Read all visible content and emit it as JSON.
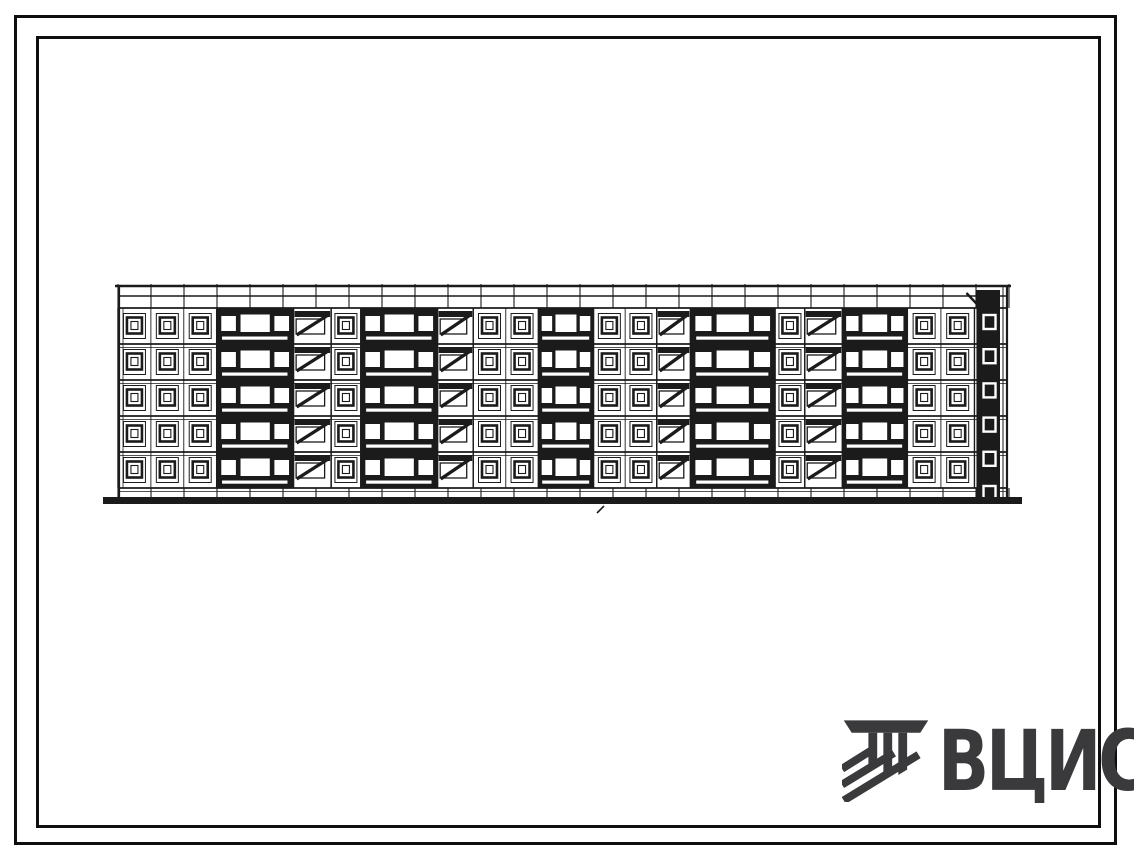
{
  "page": {
    "background": "#ffffff",
    "ink": "#1b1b1b",
    "paper": "#ffffff"
  },
  "frame": {
    "outer": "double rectangular border",
    "inner": "inner rectangular border"
  },
  "logo": {
    "text": "ВЦИС",
    "color": "#3a3a3c",
    "icon": "vcis-hatched-emblem-icon"
  },
  "drawing": {
    "type": "building-elevation",
    "subject": "5-storey large-panel apartment building, main facade elevation (scanned line drawing)",
    "floors": 5,
    "geometry": {
      "x": 118,
      "top": 286,
      "width": 890,
      "ground": 497,
      "parapet_h": 10,
      "band_h": 12,
      "plinth_h": 9,
      "ground_left_ext": 15,
      "ground_right_ext": 14,
      "ground_thickness": 7,
      "panel_step": 33
    },
    "artifact_mark": {
      "x": 597,
      "y": 510
    },
    "sections": [
      {
        "type": "win",
        "cols": 3,
        "w": 100
      },
      {
        "type": "bal",
        "w": 78
      },
      {
        "type": "stair",
        "w": 38
      },
      {
        "type": "win",
        "cols": 1,
        "w": 30
      },
      {
        "type": "bal",
        "w": 78
      },
      {
        "type": "stair",
        "w": 36
      },
      {
        "type": "win",
        "cols": 2,
        "w": 66
      },
      {
        "type": "bal",
        "w": 56
      },
      {
        "type": "win",
        "cols": 2,
        "w": 64
      },
      {
        "type": "stair",
        "w": 34
      },
      {
        "type": "bal",
        "w": 86
      },
      {
        "type": "win",
        "cols": 1,
        "w": 30
      },
      {
        "type": "stair",
        "w": 38
      },
      {
        "type": "bal",
        "w": 66
      },
      {
        "type": "win",
        "cols": 2,
        "w": 68
      },
      {
        "type": "end",
        "w": 34
      }
    ]
  }
}
